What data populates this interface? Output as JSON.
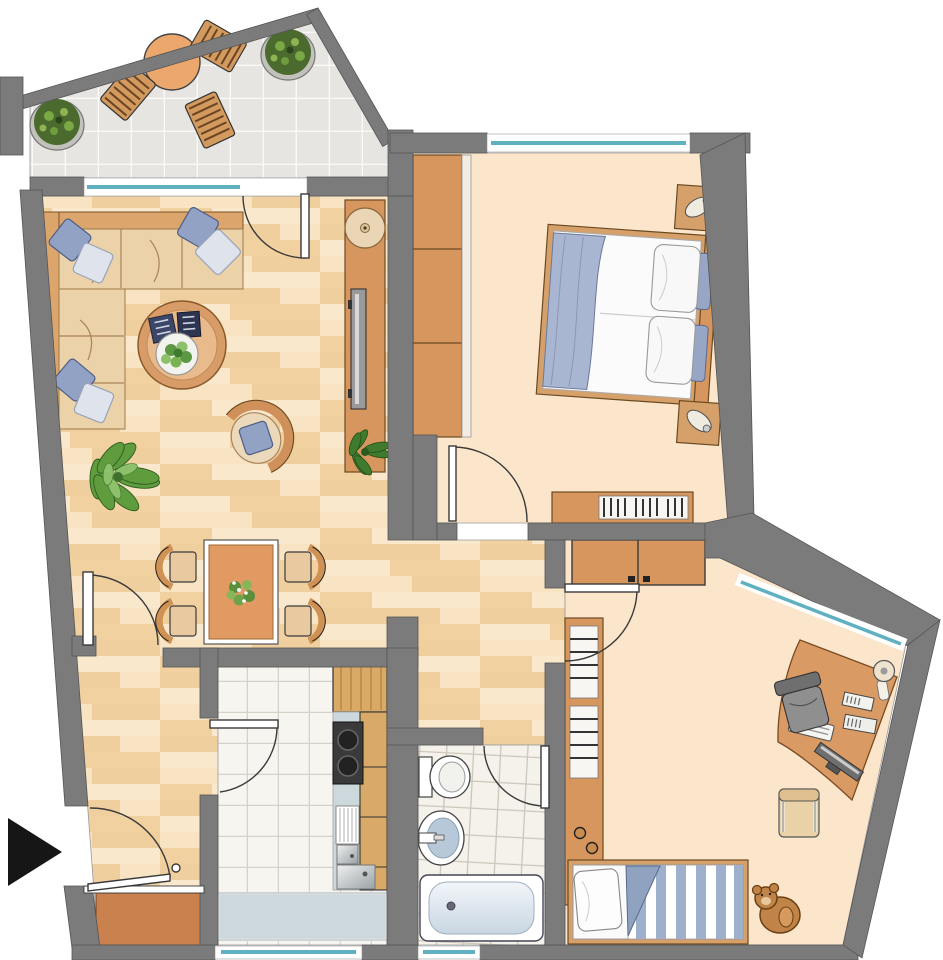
{
  "document": {
    "type": "architectural floor plan (top view)",
    "canvas": {
      "width": 943,
      "height": 960
    },
    "text_labels": [],
    "entrance_marker": "solid black triangle arrow pointing right at the apartment entrance door (bottom left)"
  },
  "colors": {
    "wall": "#7b7b7b",
    "wall_outline": "#555555",
    "glass": "#5fb0c0",
    "window_white": "#ffffff",
    "wood_base": "#f4d8ae",
    "plank_a": "#f8e3c2",
    "plank_b": "#efcf9d",
    "plank_c": "#fae8cd",
    "plank_d": "#f1d1a0",
    "room_peach": "#fbe5cb",
    "balcony_tile": "#e6e5e1",
    "balcony_grout": "#f9f9f7",
    "kitchen_tile": "#f7f5f0",
    "kitchen_grout": "#d6d2c8",
    "bath_tile": "#f5f2eb",
    "bath_grout": "#ccc6ba",
    "furniture_orange": "#d6965e",
    "furniture_outline": "#6b4a22",
    "wood_cabinet": "#d9a967",
    "sofa_seat": "#ecd2a8",
    "sofa_back": "#dca56c",
    "cushion_blue": "#92a2c4",
    "cushion_light": "#dfe3ec",
    "bed_white": "#fbfbfb",
    "blanket_blue": "#a9b6d2",
    "stripe_blue": "#9fb0cd",
    "tub_blue": "#dce7f0",
    "sink_blue": "#b7c8d8",
    "counter_gray": "#cdd8dc",
    "stove_dark": "#3a3a3a",
    "chair_gray": "#8f8f8f",
    "plant_dark": "#4a6b2d",
    "plant_light": "#7fae45",
    "leaf_green": "#5e9c3e",
    "teddy_brown": "#c08448",
    "arrow_black": "#161616",
    "landing_brown": "#c9824d"
  },
  "rooms": [
    {
      "id": "balcony",
      "label": "balcony",
      "floor": "gray tiles",
      "furniture": [
        "round bistro table",
        "3 slatted wooden chairs",
        "2 potted shrubs"
      ]
    },
    {
      "id": "living-room",
      "label": "living room",
      "floor": "wood parquet",
      "furniture": [
        "corner sofa with 6 throw cushions",
        "round coffee table with plant and books",
        "curved armchair with cushion",
        "floor plant",
        "sideboard with bowl, tv and plant"
      ]
    },
    {
      "id": "dining-area",
      "label": "dining area",
      "floor": "wood parquet",
      "furniture": [
        "rectangular dining table",
        "4 chairs",
        "flower centerpiece"
      ]
    },
    {
      "id": "hallway",
      "label": "hallway / entry",
      "floor": "wood parquet",
      "furniture": []
    },
    {
      "id": "bedroom",
      "label": "bedroom",
      "floor": "plain light",
      "furniture": [
        "double bed with 2 pillow pairs and blue runner",
        "2 nightstands with lamps",
        "3-section wardrobe",
        "low shelf with books"
      ]
    },
    {
      "id": "kitchen",
      "label": "kitchen",
      "floor": "white tiles",
      "furniture": [
        "tall wood cabinet",
        "cooktop with 2 burners",
        "wood base cabinets",
        "sink with drainboard",
        "counter along window"
      ]
    },
    {
      "id": "bathroom",
      "label": "bathroom",
      "floor": "white tiles",
      "furniture": [
        "toilet",
        "washbasin",
        "bathtub"
      ]
    },
    {
      "id": "kids-room",
      "label": "kids room / office",
      "floor": "plain light",
      "furniture": [
        "two-door wardrobe",
        "tall shelf with books",
        "single bed with striped duvet and pillow",
        "teddy bear",
        "curved corner desk with monitor, keyboard, books, lamp",
        "office swivel chair",
        "side chair"
      ]
    }
  ],
  "openings": {
    "windows": [
      {
        "room": "living-room",
        "side": "north (to balcony)"
      },
      {
        "room": "bedroom",
        "side": "north"
      },
      {
        "room": "kids-room",
        "side": "north-east (slanted wall)"
      },
      {
        "room": "kitchen",
        "side": "south"
      },
      {
        "room": "bathroom",
        "side": "south"
      }
    ],
    "doors": [
      {
        "from": "living-room",
        "to": "balcony"
      },
      {
        "from": "hallway",
        "to": "living-room"
      },
      {
        "from": "hallway",
        "to": "bedroom"
      },
      {
        "from": "hallway",
        "to": "kids-room"
      },
      {
        "from": "hallway",
        "to": "bathroom"
      },
      {
        "from": "hallway",
        "to": "kitchen"
      },
      {
        "from": "outside",
        "to": "hallway",
        "note": "apartment entrance, marked with black arrow"
      }
    ]
  }
}
